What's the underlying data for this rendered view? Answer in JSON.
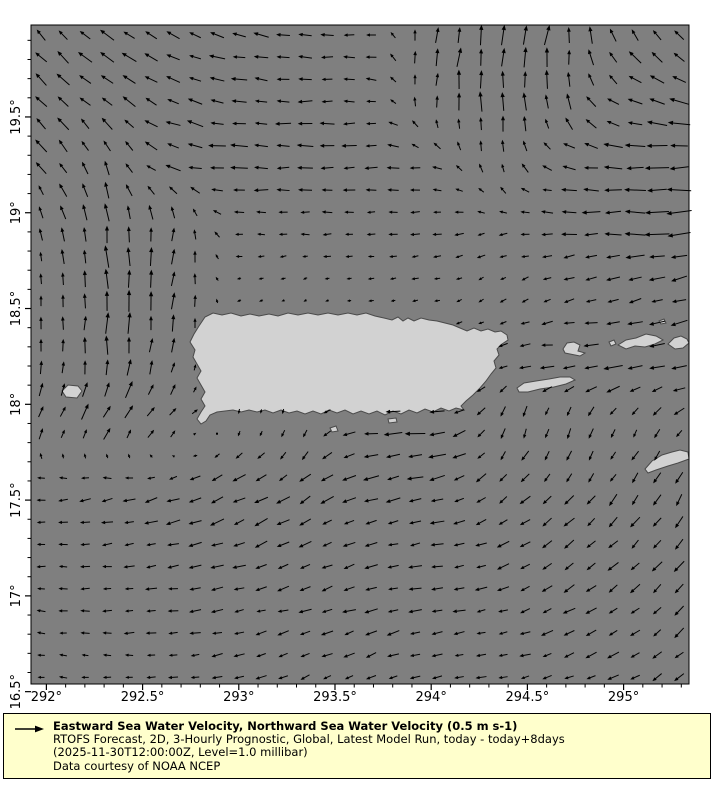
{
  "colors": {
    "ocean": "#7f7f7f",
    "land": "#d2d2d2",
    "coast": "#4a4a4a",
    "arrow": "#000000",
    "plot_border": "#000000",
    "legend_bg": "#ffffcc",
    "text": "#000000",
    "page_bg": "#ffffff"
  },
  "chart_data": {
    "type": "quiver",
    "title": "Eastward Sea Water Velocity, Northward Sea Water Velocity (0.5 m s-1)",
    "subtitle_lines": [
      "RTOFS Forecast, 2D, 3-Hourly Prognostic, Global, Latest Model Run, today - today+8days",
      "(2025-11-30T12:00:00Z, Level=1.0 millibar)",
      "Data courtesy of NOAA NCEP"
    ],
    "reference_vector": {
      "label": "0.5 m s-1",
      "length_px": 26
    },
    "lon_range": [
      291.92,
      295.34
    ],
    "lat_range": [
      16.54,
      19.98
    ],
    "x_ticks": [
      {
        "lon": 292.0,
        "label": "292°"
      },
      {
        "lon": 292.5,
        "label": "292.5°"
      },
      {
        "lon": 293.0,
        "label": "293°"
      },
      {
        "lon": 293.5,
        "label": "293.5°"
      },
      {
        "lon": 294.0,
        "label": "294°"
      },
      {
        "lon": 294.5,
        "label": "294.5°"
      },
      {
        "lon": 295.0,
        "label": "295°"
      }
    ],
    "y_ticks": [
      {
        "lat": 19.5,
        "label": "19.5°"
      },
      {
        "lat": 19.0,
        "label": "19°"
      },
      {
        "lat": 18.5,
        "label": "18.5°"
      },
      {
        "lat": 18.0,
        "label": "18°"
      },
      {
        "lat": 17.5,
        "label": "17.5°"
      },
      {
        "lat": 17.0,
        "label": "17°"
      },
      {
        "lat": 16.5,
        "label": "16.5°"
      }
    ],
    "minor_tick_step_deg": 0.1,
    "arrow_grid": {
      "x0": 41,
      "y0": 35,
      "dx": 22.0,
      "dy": 22.15,
      "cols": 30,
      "rows": 30
    },
    "field": {
      "lons": [
        292.0,
        292.33,
        292.66,
        293.0,
        293.33,
        293.66,
        294.0,
        294.33,
        294.66,
        295.0,
        295.3
      ],
      "lats": [
        19.95,
        19.6,
        19.26,
        18.92,
        18.58,
        18.24,
        17.9,
        17.56,
        17.22,
        16.88,
        16.55
      ],
      "dir_deg": [
        [
          135,
          140,
          150,
          168,
          175,
          180,
          75,
          85,
          80,
          120,
          135
        ],
        [
          138,
          145,
          155,
          172,
          178,
          182,
          82,
          90,
          95,
          155,
          165
        ],
        [
          128,
          112,
          168,
          178,
          180,
          181,
          172,
          95,
          165,
          180,
          183
        ],
        [
          108,
          95,
          85,
          180,
          180,
          183,
          186,
          192,
          182,
          181,
          182
        ],
        [
          96,
          90,
          84,
          200,
          212,
          186,
          192,
          214,
          205,
          198,
          196
        ],
        [
          86,
          88,
          72,
          180,
          185,
          185,
          188,
          195,
          181,
          181,
          186
        ],
        [
          60,
          55,
          45,
          268,
          262,
          188,
          184,
          248,
          262,
          247,
          232
        ],
        [
          186,
          192,
          200,
          206,
          214,
          196,
          191,
          220,
          226,
          234,
          240
        ],
        [
          180,
          186,
          191,
          196,
          209,
          196,
          191,
          199,
          214,
          224,
          233
        ],
        [
          176,
          181,
          186,
          191,
          196,
          196,
          191,
          194,
          205,
          214,
          224
        ],
        [
          175,
          178,
          183,
          199,
          204,
          209,
          196,
          191,
          196,
          209,
          214
        ]
      ],
      "len_px": [
        [
          15,
          15,
          15,
          15,
          13,
          12,
          16,
          20,
          19,
          16,
          15
        ],
        [
          16,
          15,
          15,
          15,
          13,
          12,
          14,
          19,
          16,
          15,
          18
        ],
        [
          14,
          13,
          15,
          17,
          15,
          13,
          10,
          12,
          12,
          20,
          22
        ],
        [
          12,
          18,
          15,
          8,
          9,
          9,
          9,
          9,
          13,
          21,
          23
        ],
        [
          10,
          22,
          17,
          4,
          4,
          5,
          6,
          7,
          9,
          13,
          14
        ],
        [
          12,
          20,
          13,
          3,
          3,
          4,
          5,
          8,
          16,
          20,
          18
        ],
        [
          13,
          16,
          11,
          6,
          7,
          16,
          19,
          11,
          11,
          10,
          10
        ],
        [
          10,
          12,
          14,
          15,
          13,
          15,
          14,
          12,
          12,
          12,
          12
        ],
        [
          8,
          10,
          12,
          12,
          12,
          12,
          12,
          12,
          12,
          13,
          13
        ],
        [
          8,
          9,
          10,
          11,
          12,
          12,
          12,
          10,
          12,
          12,
          12
        ],
        [
          8,
          8,
          10,
          10,
          10,
          10,
          10,
          10,
          10,
          12,
          12
        ]
      ]
    },
    "islands": [
      {
        "name": "puerto-rico",
        "pts": [
          [
            190,
            342
          ],
          [
            194,
            334
          ],
          [
            199,
            326
          ],
          [
            205,
            317
          ],
          [
            213,
            313
          ],
          [
            222,
            315
          ],
          [
            231,
            313
          ],
          [
            241,
            316
          ],
          [
            250,
            314
          ],
          [
            259,
            316
          ],
          [
            269,
            314
          ],
          [
            278,
            316
          ],
          [
            288,
            313
          ],
          [
            298,
            315
          ],
          [
            308,
            313
          ],
          [
            318,
            315
          ],
          [
            328,
            313
          ],
          [
            338,
            315
          ],
          [
            348,
            313
          ],
          [
            357,
            315
          ],
          [
            366,
            313
          ],
          [
            375,
            316
          ],
          [
            384,
            318
          ],
          [
            392,
            320
          ],
          [
            398,
            317
          ],
          [
            403,
            321
          ],
          [
            408,
            318
          ],
          [
            414,
            321
          ],
          [
            421,
            318
          ],
          [
            429,
            320
          ],
          [
            437,
            321
          ],
          [
            445,
            323
          ],
          [
            453,
            325
          ],
          [
            460,
            328
          ],
          [
            467,
            331
          ],
          [
            474,
            328
          ],
          [
            481,
            331
          ],
          [
            488,
            329
          ],
          [
            495,
            332
          ],
          [
            501,
            331
          ],
          [
            507,
            335
          ],
          [
            508,
            340
          ],
          [
            502,
            344
          ],
          [
            497,
            349
          ],
          [
            499,
            355
          ],
          [
            494,
            361
          ],
          [
            496,
            368
          ],
          [
            491,
            374
          ],
          [
            486,
            381
          ],
          [
            480,
            388
          ],
          [
            473,
            395
          ],
          [
            466,
            401
          ],
          [
            461,
            406
          ],
          [
            464,
            410
          ],
          [
            456,
            408
          ],
          [
            449,
            411
          ],
          [
            441,
            408
          ],
          [
            433,
            412
          ],
          [
            425,
            409
          ],
          [
            417,
            413
          ],
          [
            409,
            410
          ],
          [
            401,
            414
          ],
          [
            393,
            411
          ],
          [
            385,
            415
          ],
          [
            377,
            411
          ],
          [
            369,
            414
          ],
          [
            361,
            411
          ],
          [
            353,
            414
          ],
          [
            345,
            410
          ],
          [
            337,
            413
          ],
          [
            329,
            410
          ],
          [
            321,
            414
          ],
          [
            313,
            411
          ],
          [
            305,
            414
          ],
          [
            297,
            411
          ],
          [
            289,
            413
          ],
          [
            281,
            410
          ],
          [
            273,
            413
          ],
          [
            265,
            410
          ],
          [
            257,
            412
          ],
          [
            249,
            410
          ],
          [
            241,
            412
          ],
          [
            233,
            410
          ],
          [
            225,
            411
          ],
          [
            217,
            412
          ],
          [
            210,
            415
          ],
          [
            206,
            421
          ],
          [
            201,
            424
          ],
          [
            197,
            419
          ],
          [
            201,
            412
          ],
          [
            205,
            406
          ],
          [
            201,
            399
          ],
          [
            205,
            392
          ],
          [
            201,
            385
          ],
          [
            197,
            378
          ],
          [
            201,
            371
          ],
          [
            197,
            364
          ],
          [
            193,
            357
          ],
          [
            195,
            350
          ]
        ]
      },
      {
        "name": "mona",
        "pts": [
          [
            62,
            391
          ],
          [
            68,
            385
          ],
          [
            78,
            386
          ],
          [
            82,
            391
          ],
          [
            77,
            398
          ],
          [
            66,
            397
          ]
        ]
      },
      {
        "name": "vieques",
        "pts": [
          [
            517,
            388
          ],
          [
            524,
            383
          ],
          [
            536,
            381
          ],
          [
            549,
            379
          ],
          [
            560,
            377
          ],
          [
            570,
            377
          ],
          [
            575,
            380
          ],
          [
            566,
            384
          ],
          [
            554,
            387
          ],
          [
            540,
            389
          ],
          [
            528,
            392
          ],
          [
            519,
            392
          ]
        ]
      },
      {
        "name": "culebra",
        "pts": [
          [
            563,
            349
          ],
          [
            567,
            343
          ],
          [
            574,
            342
          ],
          [
            580,
            345
          ],
          [
            578,
            351
          ],
          [
            585,
            353
          ],
          [
            580,
            356
          ],
          [
            570,
            354
          ],
          [
            565,
            353
          ]
        ]
      },
      {
        "name": "st-thomas",
        "pts": [
          [
            618,
            345
          ],
          [
            626,
            340
          ],
          [
            636,
            338
          ],
          [
            646,
            334
          ],
          [
            656,
            336
          ],
          [
            663,
            340
          ],
          [
            655,
            344
          ],
          [
            645,
            347
          ],
          [
            635,
            346
          ],
          [
            626,
            349
          ]
        ]
      },
      {
        "name": "west-cay",
        "pts": [
          [
            609,
            342
          ],
          [
            614,
            340
          ],
          [
            616,
            344
          ],
          [
            611,
            346
          ]
        ]
      },
      {
        "name": "tortola",
        "pts": [
          [
            668,
            344
          ],
          [
            674,
            338
          ],
          [
            681,
            336
          ],
          [
            687,
            339
          ],
          [
            689,
            343
          ],
          [
            683,
            348
          ],
          [
            675,
            349
          ]
        ]
      },
      {
        "name": "st-croix",
        "pts": [
          [
            645,
            469
          ],
          [
            652,
            461
          ],
          [
            662,
            455
          ],
          [
            672,
            452
          ],
          [
            680,
            450
          ],
          [
            688,
            452
          ],
          [
            689,
            459
          ],
          [
            678,
            463
          ],
          [
            668,
            466
          ],
          [
            656,
            470
          ],
          [
            648,
            473
          ]
        ]
      },
      {
        "name": "caja-de-muertos",
        "pts": [
          [
            330,
            428
          ],
          [
            336,
            426
          ],
          [
            338,
            431
          ],
          [
            332,
            432
          ]
        ]
      },
      {
        "name": "ne-cay",
        "pts": [
          [
            659,
            321
          ],
          [
            664,
            319
          ],
          [
            666,
            323
          ],
          [
            661,
            324
          ]
        ]
      },
      {
        "name": "south-islet",
        "pts": [
          [
            388,
            419
          ],
          [
            396,
            418
          ],
          [
            397,
            422
          ],
          [
            389,
            423
          ]
        ]
      }
    ]
  }
}
